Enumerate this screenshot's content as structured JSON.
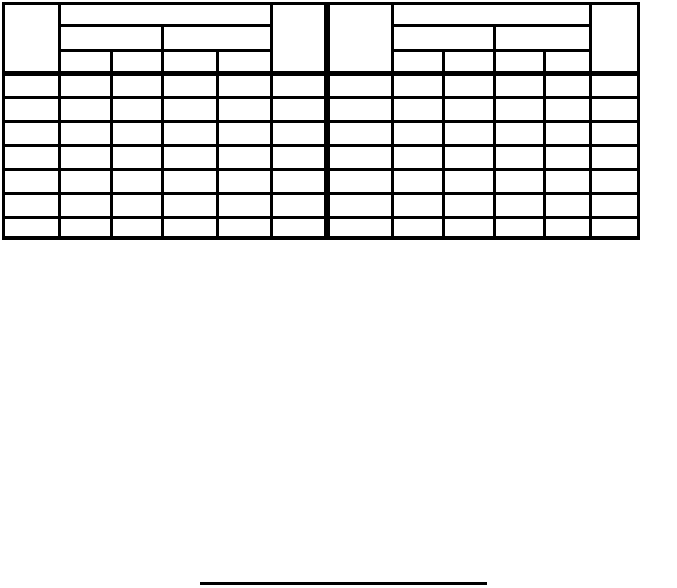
{
  "canvas": {
    "background_color": "#ffffff",
    "line_color": "#000000"
  },
  "table": {
    "description": "blank two-panel table, all cells empty",
    "data_row_count": 7,
    "panels": [
      {
        "side": "left",
        "header": {
          "row_label_column": "",
          "group": "",
          "subgroups": [
            "",
            ""
          ],
          "leaf_columns": [
            "",
            "",
            "",
            ""
          ],
          "end_column": ""
        },
        "rows": [
          [
            "",
            "",
            "",
            "",
            "",
            ""
          ],
          [
            "",
            "",
            "",
            "",
            "",
            ""
          ],
          [
            "",
            "",
            "",
            "",
            "",
            ""
          ],
          [
            "",
            "",
            "",
            "",
            "",
            ""
          ],
          [
            "",
            "",
            "",
            "",
            "",
            ""
          ],
          [
            "",
            "",
            "",
            "",
            "",
            ""
          ],
          [
            "",
            "",
            "",
            "",
            "",
            ""
          ]
        ]
      },
      {
        "side": "right",
        "header": {
          "row_label_column": "",
          "group": "",
          "subgroups": [
            "",
            ""
          ],
          "leaf_columns": [
            "",
            "",
            "",
            ""
          ],
          "end_column": ""
        },
        "rows": [
          [
            "",
            "",
            "",
            "",
            "",
            ""
          ],
          [
            "",
            "",
            "",
            "",
            "",
            ""
          ],
          [
            "",
            "",
            "",
            "",
            "",
            ""
          ],
          [
            "",
            "",
            "",
            "",
            "",
            ""
          ],
          [
            "",
            "",
            "",
            "",
            "",
            ""
          ],
          [
            "",
            "",
            "",
            "",
            "",
            ""
          ],
          [
            "",
            "",
            "",
            "",
            "",
            ""
          ]
        ]
      }
    ]
  },
  "footnote_rule": {
    "color": "#000000"
  }
}
